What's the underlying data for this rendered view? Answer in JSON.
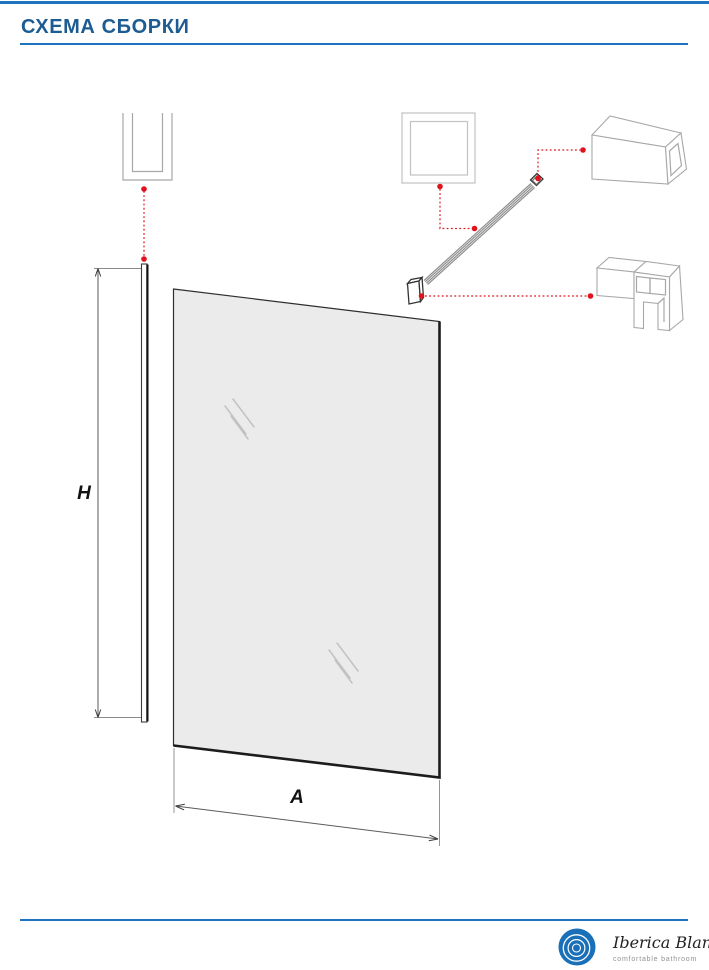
{
  "header": {
    "title": "СХЕМА СБОРКИ"
  },
  "diagram": {
    "dimension_labels": {
      "height": "H",
      "width": "A"
    },
    "components": [
      {
        "name": "u-channel-wall-profile-icon"
      },
      {
        "name": "square-profile-section-icon"
      },
      {
        "name": "wall-mount-end-box-icon"
      },
      {
        "name": "support-bar"
      },
      {
        "name": "support-bar-glass-clamp"
      },
      {
        "name": "glass-clamp-bracket-icon"
      },
      {
        "name": "wall-profile-strip"
      },
      {
        "name": "glass-panel"
      }
    ]
  },
  "footer": {
    "brand": "Iberica Blanca",
    "tagline": "comfortable bathroom"
  },
  "colors": {
    "accent_blue": "#1e73be",
    "title_blue": "#1d5c92",
    "leader_red": "#e0121b",
    "icon_outline_gray": "#a8a8a8",
    "glass_fill": "#ebebeb",
    "drawing_dark": "#1c1c1c",
    "logo_blue": "#1a70b8"
  }
}
